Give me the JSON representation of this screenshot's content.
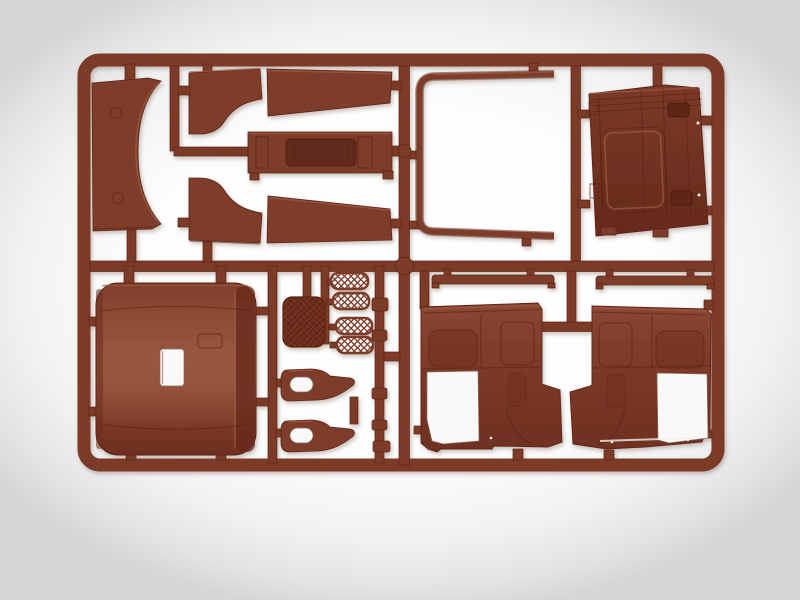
{
  "scene": {
    "type": "photograph",
    "subject": "Injection-molded plastic model kit sprue (parts tree) of truck cab components, reddish-brown styrene on a white light-box background",
    "orientation": "landscape",
    "visible_text": ""
  },
  "palette": {
    "runner": "#7c3a28",
    "runner_edge": "#5e2416",
    "part": "#7e3c2a",
    "part_light": "#9b5b43",
    "part_dark": "#5c2415",
    "part_deep": "#652a1b",
    "recess": "#61291a",
    "hole_white": "#faf9f8",
    "background_center": "#ffffff",
    "background_edge": "#d6d6d8"
  },
  "sprue": {
    "frame": "rounded rectangular outer runner frame",
    "junction": "round runner node at frame center",
    "material": "brown plastic"
  },
  "parts": [
    {
      "id": "wind-deflector",
      "desc": "curved side deflector panel, concave right edge, top left of frame"
    },
    {
      "id": "roof-fairing-upper",
      "desc": "boot-shaped roof fairing segment, upper middle"
    },
    {
      "id": "roof-slat-upper",
      "desc": "long tapered slab segment, upper middle"
    },
    {
      "id": "cab-rear-valance",
      "desc": "narrow ribbed panel with recessed center rectangle"
    },
    {
      "id": "roof-fairing-lower",
      "desc": "mirrored boot-shaped roof fairing segment"
    },
    {
      "id": "roof-slat-lower",
      "desc": "mirrored long tapered slab segment"
    },
    {
      "id": "windshield-frame",
      "desc": "thin U-shaped windshield surround, open to the right"
    },
    {
      "id": "cab-back-panel",
      "desc": "large trapezoid back wall panel with recessed rectangle and latch details"
    },
    {
      "id": "cab-roof",
      "desc": "large rounded roof panel with white sunroof opening"
    },
    {
      "id": "cabin-mat",
      "desc": "small quilted square mat"
    },
    {
      "id": "step-grille-1",
      "desc": "perforated step tread with diamond mesh"
    },
    {
      "id": "step-grille-2",
      "desc": "perforated step tread with diamond mesh"
    },
    {
      "id": "step-grille-3",
      "desc": "perforated step tread with diamond mesh"
    },
    {
      "id": "step-grille-4",
      "desc": "perforated step tread with diamond mesh"
    },
    {
      "id": "armrest-1",
      "desc": "horn-shaped armrest piece with oval opening"
    },
    {
      "id": "armrest-2",
      "desc": "horn-shaped armrest piece with oval opening"
    },
    {
      "id": "trim-strip-left",
      "desc": "thin trim strip hanging under center rail"
    },
    {
      "id": "trim-strip-right",
      "desc": "thin trim strip hanging under center rail"
    },
    {
      "id": "door-card-left",
      "desc": "interior door panel with window cutout, lower left window opening"
    },
    {
      "id": "door-card-right",
      "desc": "mirrored interior door panel with window cutout"
    }
  ]
}
